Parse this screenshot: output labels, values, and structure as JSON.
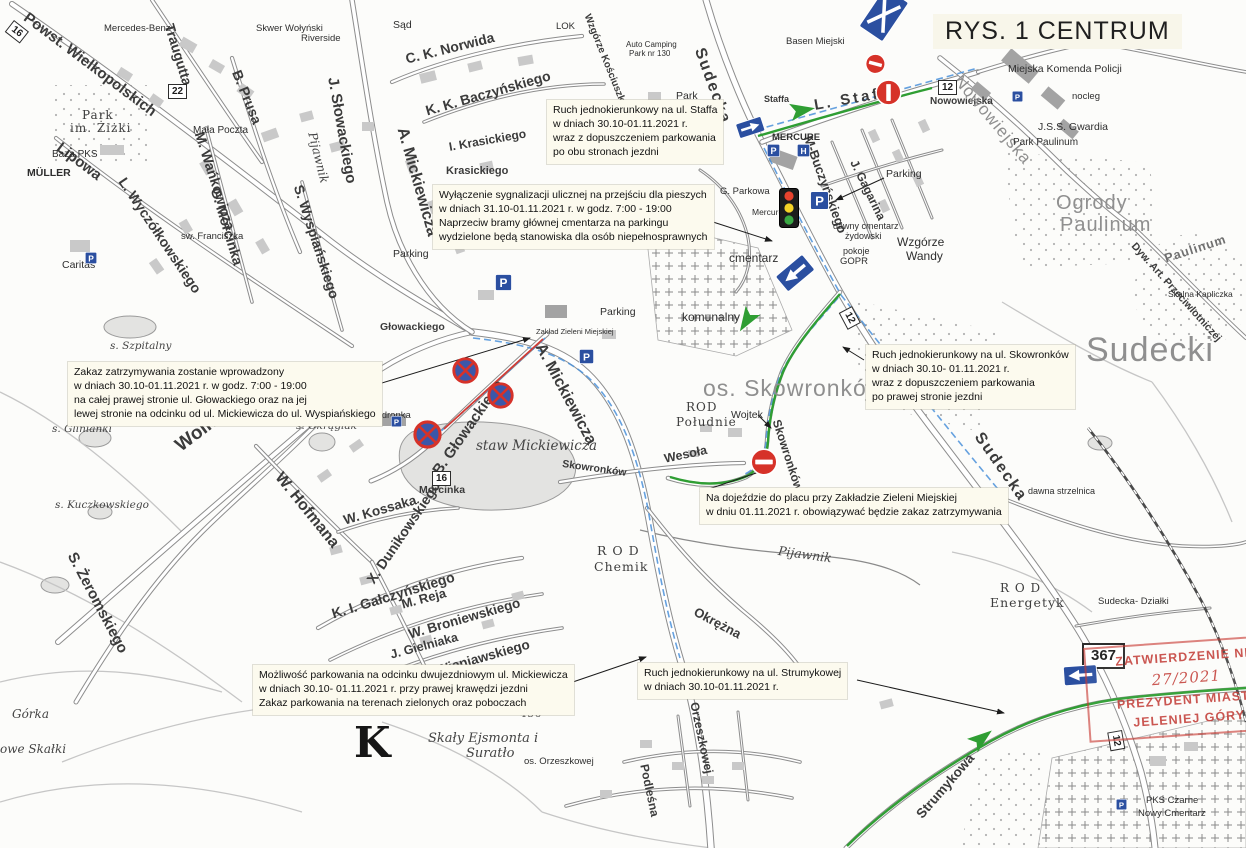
{
  "title": "RYS. 1 CENTRUM",
  "colors": {
    "route_green": "#2f9e33",
    "bus_blue": "#4a90d9",
    "sign_blue": "#2b4fa0",
    "sign_blue2": "#3b57a9",
    "sign_red": "#d63229",
    "red_line": "#d23b33",
    "stamp_red": "#c4403a",
    "note_bg": "#fcfaee",
    "light_red": "#e8432e",
    "light_yellow": "#f5d327",
    "light_green": "#3aa843"
  },
  "annotations": [
    {
      "x": 547,
      "y": 100,
      "lines": [
        "Ruch jednokierunkowy na ul. Staffa",
        "w dniach 30.10-01.11.2021 r.",
        "wraz z dopuszczeniem parkowania",
        "po obu stronach jezdni"
      ]
    },
    {
      "x": 433,
      "y": 185,
      "lines": [
        "Wyłączenie sygnalizacji ulicznej na przejściu dla pieszych",
        "w dniach 31.10-01.11.2021 r. w godz. 7:00 - 19:00",
        "Naprzeciw bramy głównej cmentarza na parkingu",
        "wydzielone będą stanowiska dla osób niepełnosprawnych"
      ]
    },
    {
      "x": 68,
      "y": 362,
      "lines": [
        "Zakaz zatrzymywania zostanie wprowadzony",
        "w dniach 30.10-01.11.2021 r. w godz. 7:00 - 19:00",
        "na całej prawej stronie ul. Głowackiego oraz na jej",
        "lewej stronie na odcinku od ul. Mickiewicza do ul. Wyspiańskiego"
      ]
    },
    {
      "x": 866,
      "y": 345,
      "lines": [
        "Ruch jednokierunkowy na ul. Skowronków",
        "w dniach 30.10- 01.11.2021 r.",
        "wraz z dopuszczeniem parkowania",
        "po prawej stronie jezdni"
      ]
    },
    {
      "x": 700,
      "y": 488,
      "lines": [
        "Na dojeździe do placu przy Zakładzie Zieleni Miejskiej",
        "w dniu 01.11.2021 r. obowiązywać będzie zakaz zatrzymywania"
      ]
    },
    {
      "x": 253,
      "y": 665,
      "lines": [
        "Możliwość parkowania na odcinku dwujezdniowym ul. Mickiewicza",
        "w dniach 30.10- 01.11.2021 r. przy prawej krawędzi jezdni",
        "Zakaz parkowania na terenach zielonych oraz poboczach"
      ]
    },
    {
      "x": 638,
      "y": 663,
      "lines": [
        "Ruch jednokierunkowy na ul. Strumykowej",
        "w dniach 30.10-01.11.2021 r."
      ]
    }
  ],
  "stamp": {
    "lines": [
      "ZATWIERDZENIE NR",
      "27/2021",
      "PREZYDENT MIASTA",
      "JELENIEJ GÓRY"
    ]
  },
  "map": {
    "labels": [
      {
        "t": "Powst. Wielkopolskich",
        "x": 30,
        "y": 10,
        "r": 37,
        "s": 15
      },
      {
        "t": "Lipowa",
        "x": 63,
        "y": 140,
        "r": 37,
        "s": 15
      },
      {
        "t": "Traugutta",
        "x": 176,
        "y": 22,
        "r": 73,
        "s": 14
      },
      {
        "t": "B. Prusa",
        "x": 243,
        "y": 68,
        "r": 68,
        "s": 14
      },
      {
        "t": "Wolności",
        "x": 172,
        "y": 440,
        "r": -37,
        "s": 19
      },
      {
        "t": "S. Żeromskiego",
        "x": 78,
        "y": 550,
        "r": 62,
        "s": 15
      },
      {
        "t": "L. Wyczółkowskiego",
        "x": 128,
        "y": 175,
        "r": 56,
        "s": 14
      },
      {
        "t": "M. Wańkowicza",
        "x": 206,
        "y": 130,
        "r": 72,
        "s": 14
      },
      {
        "t": "G. Morcinka",
        "x": 222,
        "y": 186,
        "r": 73,
        "s": 14
      },
      {
        "t": "S. Wyspiańskiego",
        "x": 305,
        "y": 183,
        "r": 72,
        "s": 14
      },
      {
        "t": "J. Słowackiego",
        "x": 340,
        "y": 76,
        "r": 80,
        "s": 15
      },
      {
        "t": "C. K. Norwida",
        "x": 404,
        "y": 52,
        "r": -14,
        "s": 14
      },
      {
        "t": "K. K. Baczyńskiego",
        "x": 424,
        "y": 104,
        "r": -16,
        "s": 14
      },
      {
        "t": "A. Mickiewicza",
        "x": 409,
        "y": 126,
        "r": 74,
        "s": 16
      },
      {
        "t": "I. Krasickiego",
        "x": 448,
        "y": 141,
        "r": -10,
        "s": 12
      },
      {
        "t": "Krasickiego",
        "x": 446,
        "y": 166,
        "s": 11
      },
      {
        "t": "A. Mickiewicza",
        "x": 546,
        "y": 341,
        "r": 62,
        "s": 16
      },
      {
        "t": "B. Głowackiego",
        "x": 430,
        "y": 469,
        "r": -55,
        "s": 15
      },
      {
        "t": "Głowackiego",
        "x": 380,
        "y": 322,
        "s": 10.5
      },
      {
        "t": "W. Hofmana",
        "x": 284,
        "y": 470,
        "r": 51,
        "s": 16
      },
      {
        "t": "W. Kossaka",
        "x": 342,
        "y": 514,
        "r": -16,
        "s": 13.5
      },
      {
        "t": "X. Dunikowskiego",
        "x": 364,
        "y": 578,
        "r": -56,
        "s": 14
      },
      {
        "t": "K. I. Gałczyńskiego",
        "x": 330,
        "y": 607,
        "r": -17,
        "s": 14
      },
      {
        "t": "M. Reja",
        "x": 400,
        "y": 598,
        "r": -15,
        "s": 13
      },
      {
        "t": "W. Broniewskiego",
        "x": 407,
        "y": 628,
        "r": -16,
        "s": 13.5
      },
      {
        "t": "J. Gielniaka",
        "x": 389,
        "y": 649,
        "r": -15,
        "s": 12.5
      },
      {
        "t": "H. Wieniawskiego",
        "x": 418,
        "y": 669,
        "r": -16,
        "s": 13.5
      },
      {
        "t": "Morcinka",
        "x": 419,
        "y": 485,
        "s": 10.5
      },
      {
        "t": "Sudecka",
        "x": 706,
        "y": 46,
        "r": 70,
        "s": 16,
        "ls": 2
      },
      {
        "t": "L. Staffa",
        "x": 813,
        "y": 98,
        "r": -10,
        "s": 15,
        "ls": 3
      },
      {
        "t": "Staffa",
        "x": 764,
        "y": 95,
        "s": 9
      },
      {
        "t": "M-Buczyńskiego",
        "x": 814,
        "y": 134,
        "r": 70,
        "s": 13
      },
      {
        "t": "J. Gagarina",
        "x": 859,
        "y": 158,
        "r": 64,
        "s": 12
      },
      {
        "t": "Nowowiejska",
        "x": 930,
        "y": 97,
        "s": 10
      },
      {
        "t": "Nowowiejska",
        "x": 964,
        "y": 72,
        "r": 50,
        "s": 17,
        "c": "area"
      },
      {
        "t": "Sudecka",
        "x": 984,
        "y": 430,
        "r": 55,
        "s": 16,
        "ls": 2
      },
      {
        "t": "Skowronków",
        "x": 782,
        "y": 418,
        "r": 72,
        "s": 12
      },
      {
        "t": "Wesoła",
        "x": 663,
        "y": 453,
        "r": -12,
        "s": 12.5
      },
      {
        "t": "Skowronków",
        "x": 563,
        "y": 459,
        "r": 8,
        "s": 10.5
      },
      {
        "t": "Strumykowa",
        "x": 914,
        "y": 812,
        "r": -49,
        "s": 13.5
      },
      {
        "t": "Okrężna",
        "x": 698,
        "y": 605,
        "r": 28,
        "s": 13
      },
      {
        "t": "Podleśna",
        "x": 650,
        "y": 763,
        "r": 78,
        "s": 12
      },
      {
        "t": "Orzeszkowej",
        "x": 700,
        "y": 701,
        "r": 78,
        "s": 12
      },
      {
        "t": "Dyw. Art. Przeciwlotniczej",
        "x": 1137,
        "y": 241,
        "r": 48,
        "s": 10.5
      },
      {
        "t": "Wzgórze Kościuszki",
        "x": 591,
        "y": 13,
        "r": 68,
        "s": 10
      },
      {
        "t": "Mercedes-Benz",
        "x": 104,
        "y": 24,
        "s": 9.5,
        "c": "poi"
      },
      {
        "t": "Sąd",
        "x": 393,
        "y": 20,
        "s": 10.5,
        "c": "poi"
      },
      {
        "t": "Riverside",
        "x": 301,
        "y": 34,
        "s": 9.5,
        "c": "poi"
      },
      {
        "t": "Skwer Wołyński",
        "x": 256,
        "y": 24,
        "s": 9.5,
        "c": "poi"
      },
      {
        "t": "Mała Poczta",
        "x": 193,
        "y": 126,
        "s": 10,
        "c": "poi"
      },
      {
        "t": "Park",
        "x": 676,
        "y": 91,
        "s": 10.5,
        "c": "poi"
      },
      {
        "t": "LOK",
        "x": 556,
        "y": 22,
        "s": 9.5,
        "c": "poi"
      },
      {
        "t": "Basen Miejski",
        "x": 786,
        "y": 37,
        "s": 9.5,
        "c": "poi"
      },
      {
        "t": "Auto Camping",
        "x": 626,
        "y": 41,
        "s": 8,
        "c": "poi"
      },
      {
        "t": "Park nr 130",
        "x": 629,
        "y": 50,
        "s": 8,
        "c": "poi"
      },
      {
        "t": "Miejska Komenda Policji",
        "x": 1008,
        "y": 64,
        "s": 10.5,
        "c": "poi"
      },
      {
        "t": "nocleg",
        "x": 1072,
        "y": 92,
        "s": 9.5,
        "c": "poi"
      },
      {
        "t": "J.S.S. Gwardia",
        "x": 1038,
        "y": 122,
        "s": 10.5,
        "c": "poi"
      },
      {
        "t": "Park Paulinum",
        "x": 1013,
        "y": 138,
        "s": 10,
        "c": "poi"
      },
      {
        "t": "MERCURE",
        "x": 772,
        "y": 133,
        "s": 9.5,
        "c": "poib"
      },
      {
        "t": "Mercure",
        "x": 752,
        "y": 208,
        "s": 8.5,
        "c": "poi"
      },
      {
        "t": "G. Parkowa",
        "x": 720,
        "y": 187,
        "s": 9.5,
        "c": "poi"
      },
      {
        "t": "dawny cmentarz",
        "x": 833,
        "y": 222,
        "s": 9,
        "c": "poi"
      },
      {
        "t": "żydowski",
        "x": 845,
        "y": 232,
        "s": 9,
        "c": "poi"
      },
      {
        "t": "pokoje",
        "x": 843,
        "y": 247,
        "s": 9,
        "c": "poi"
      },
      {
        "t": "GOPR",
        "x": 840,
        "y": 257,
        "s": 9.5,
        "c": "poi"
      },
      {
        "t": "cmentarz",
        "x": 729,
        "y": 252,
        "s": 12,
        "c": "poi"
      },
      {
        "t": "komunalny",
        "x": 682,
        "y": 311,
        "s": 12,
        "c": "poi"
      },
      {
        "t": "Parking",
        "x": 393,
        "y": 249,
        "s": 10.5,
        "c": "poi"
      },
      {
        "t": "Parking",
        "x": 600,
        "y": 307,
        "s": 10.5,
        "c": "poi"
      },
      {
        "t": "Parking",
        "x": 886,
        "y": 169,
        "s": 10.5,
        "c": "poi"
      },
      {
        "t": "Biedronka",
        "x": 368,
        "y": 411,
        "s": 9.5,
        "c": "poi"
      },
      {
        "t": "Zakład Zieleni Miejskiej",
        "x": 536,
        "y": 328,
        "s": 7.5,
        "c": "poi"
      },
      {
        "t": "Wojtek",
        "x": 731,
        "y": 410,
        "s": 10.5,
        "c": "poi"
      },
      {
        "t": "Baza PKS",
        "x": 52,
        "y": 150,
        "s": 10,
        "c": "poi"
      },
      {
        "t": "MÜLLER",
        "x": 27,
        "y": 168,
        "s": 10.5,
        "c": "poib"
      },
      {
        "t": "Caritas",
        "x": 62,
        "y": 260,
        "s": 10.5,
        "c": "poi"
      },
      {
        "t": "sw. Franciszka",
        "x": 181,
        "y": 232,
        "s": 9.5,
        "c": "poi"
      },
      {
        "t": "dawna strzelnica",
        "x": 1028,
        "y": 487,
        "s": 9,
        "c": "poi"
      },
      {
        "t": "Sudecka- Działki",
        "x": 1098,
        "y": 597,
        "s": 9.5,
        "c": "poi"
      },
      {
        "t": "PKS Czarne",
        "x": 1146,
        "y": 796,
        "s": 9.5,
        "c": "poi"
      },
      {
        "t": "Nowy Cmentarz",
        "x": 1138,
        "y": 809,
        "s": 9.5,
        "c": "poi"
      },
      {
        "t": "Wzgórze",
        "x": 897,
        "y": 236,
        "s": 12,
        "c": "poi"
      },
      {
        "t": "Wandy",
        "x": 906,
        "y": 250,
        "s": 12,
        "c": "poi"
      },
      {
        "t": "os. Orzeszkowej",
        "x": 524,
        "y": 757,
        "s": 9.5,
        "c": "poi"
      },
      {
        "t": "os. Skowronków",
        "x": 703,
        "y": 377,
        "s": 23,
        "c": "area"
      },
      {
        "t": "Sudecki",
        "x": 1086,
        "y": 333,
        "s": 34,
        "c": "area"
      },
      {
        "t": "Ogrody",
        "x": 1056,
        "y": 193,
        "s": 20,
        "c": "area"
      },
      {
        "t": "Paulinum",
        "x": 1060,
        "y": 215,
        "s": 20,
        "c": "area"
      },
      {
        "t": "Paulinum",
        "x": 1163,
        "y": 253,
        "r": -18,
        "s": 12.5,
        "c": "area2"
      },
      {
        "t": "Skalna Kapliczka",
        "x": 1168,
        "y": 290,
        "s": 8.5,
        "c": "poi"
      },
      {
        "t": "ROD",
        "x": 686,
        "y": 401,
        "s": 12,
        "c": "rod"
      },
      {
        "t": "Południe",
        "x": 676,
        "y": 416,
        "s": 12,
        "c": "rod"
      },
      {
        "t": "R O D",
        "x": 597,
        "y": 545,
        "s": 12.5,
        "c": "rod"
      },
      {
        "t": "Chemik",
        "x": 594,
        "y": 561,
        "s": 12.5,
        "c": "rod"
      },
      {
        "t": "R O D",
        "x": 1000,
        "y": 582,
        "s": 12,
        "c": "rod"
      },
      {
        "t": "Energetyk",
        "x": 990,
        "y": 597,
        "s": 12.5,
        "c": "rod"
      },
      {
        "t": "Park",
        "x": 82,
        "y": 109,
        "s": 12,
        "c": "rod"
      },
      {
        "t": "im. Żiżki",
        "x": 70,
        "y": 122,
        "s": 12,
        "c": "rod"
      },
      {
        "t": "Złomy",
        "x": 497,
        "y": 695,
        "s": 13.5,
        "c": "rod"
      },
      {
        "t": "436",
        "x": 520,
        "y": 710,
        "s": 10,
        "c": "rod"
      },
      {
        "t": "Skały Ejsmonta i",
        "x": 428,
        "y": 732,
        "s": 13,
        "c": "water"
      },
      {
        "t": "Suratło",
        "x": 466,
        "y": 747,
        "s": 13,
        "c": "water"
      },
      {
        "t": "Górka",
        "x": 12,
        "y": 708,
        "s": 12,
        "c": "water"
      },
      {
        "t": "owe Skałki",
        "x": 0,
        "y": 743,
        "s": 12,
        "c": "water"
      },
      {
        "t": "staw Mickiewicza",
        "x": 476,
        "y": 440,
        "s": 13.5,
        "c": "water"
      },
      {
        "t": "s. Szpitalny",
        "x": 110,
        "y": 341,
        "s": 10.5,
        "c": "water"
      },
      {
        "t": "s. Glinianki",
        "x": 52,
        "y": 424,
        "s": 10.5,
        "c": "water"
      },
      {
        "t": "s. Okrąglak",
        "x": 296,
        "y": 421,
        "s": 10.5,
        "c": "water"
      },
      {
        "t": "s. Kuczkowskiego",
        "x": 55,
        "y": 500,
        "s": 10.5,
        "c": "water"
      },
      {
        "t": "Pijawnik",
        "x": 318,
        "y": 131,
        "r": 76,
        "s": 12,
        "c": "water"
      },
      {
        "t": "Pijawnik",
        "x": 779,
        "y": 545,
        "r": 8,
        "s": 12.5,
        "c": "water"
      },
      {
        "t": "K",
        "x": 354,
        "y": 722,
        "s": 42,
        "c": "bigk"
      }
    ],
    "badges": [
      {
        "t": "22",
        "x": 168,
        "y": 84
      },
      {
        "t": "16",
        "x": 432,
        "y": 471
      },
      {
        "t": "16",
        "x": 14,
        "y": 20,
        "r": 38
      },
      {
        "t": "12",
        "x": 938,
        "y": 80
      },
      {
        "t": "12",
        "x": 852,
        "y": 306,
        "r": 62
      },
      {
        "t": "12",
        "x": 1122,
        "y": 730,
        "r": 80
      },
      {
        "t": "367",
        "x": 1082,
        "y": 643,
        "big": true
      }
    ],
    "icons": [
      {
        "t": "light",
        "x": 779,
        "y": 188
      },
      {
        "t": "parking",
        "x": 495,
        "y": 274,
        "s": 17
      },
      {
        "t": "parking",
        "x": 579,
        "y": 349,
        "s": 15
      },
      {
        "t": "parking",
        "x": 810,
        "y": 191,
        "s": 19
      },
      {
        "t": "parking",
        "x": 767,
        "y": 144,
        "s": 13
      },
      {
        "t": "parking",
        "x": 391,
        "y": 416,
        "s": 11
      },
      {
        "t": "parking",
        "x": 85,
        "y": 252,
        "s": 12
      },
      {
        "t": "parking",
        "x": 1012,
        "y": 91,
        "s": 11
      },
      {
        "t": "parking",
        "x": 1116,
        "y": 799,
        "s": 11
      },
      {
        "t": "hotel",
        "x": 797,
        "y": 144,
        "s": 13
      },
      {
        "t": "oneway",
        "x": 735,
        "y": 124,
        "s": 27,
        "r": -18
      },
      {
        "t": "oneway",
        "x": 816,
        "y": 270,
        "s": 36,
        "r": 140
      },
      {
        "t": "oneway",
        "x": 1098,
        "y": 684,
        "s": 34,
        "r": 176
      },
      {
        "t": "cross",
        "x": 858,
        "y": 26,
        "s": 48,
        "r": -56
      },
      {
        "t": "noentry",
        "x": 868,
        "y": 51,
        "s": 21,
        "r": 15
      },
      {
        "t": "noentry",
        "x": 902,
        "y": 79,
        "s": 27,
        "r": 90
      },
      {
        "t": "noentry",
        "x": 750,
        "y": 448,
        "s": 28
      },
      {
        "t": "nostop",
        "x": 452,
        "y": 357,
        "s": 27
      },
      {
        "t": "nostop",
        "x": 487,
        "y": 382,
        "s": 27
      },
      {
        "t": "nostop",
        "x": 413,
        "y": 420,
        "s": 29
      },
      {
        "t": "garrow",
        "x": 786,
        "y": 99,
        "s": 28,
        "r": -10
      },
      {
        "t": "garrow",
        "x": 766,
        "y": 316,
        "s": 28,
        "r": 122
      },
      {
        "t": "garrow",
        "x": 962,
        "y": 736,
        "s": 28,
        "r": -38
      }
    ]
  }
}
